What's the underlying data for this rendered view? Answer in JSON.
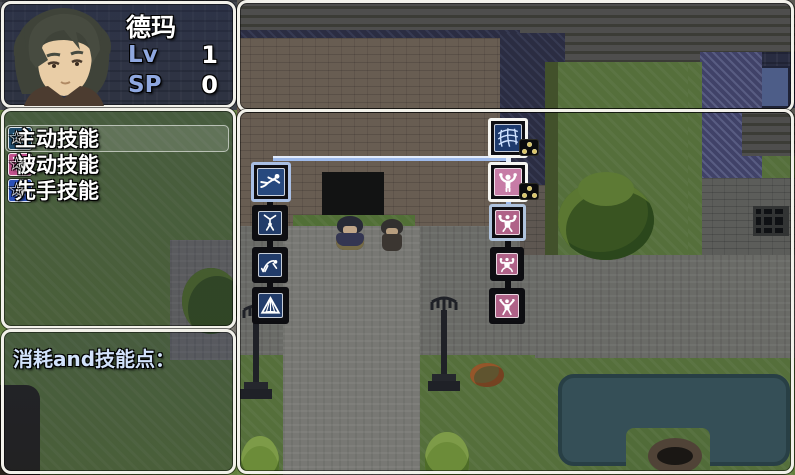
{
  "character_panel": {
    "name": "德玛",
    "level_label": "Lv",
    "level_value": "1",
    "sp_label": "SP",
    "sp_value": "0",
    "portrait_icon": "male-dark-hair-portrait"
  },
  "skill_menu": {
    "items": [
      {
        "label": "主动技能",
        "star": "☆",
        "icon": "fist-icon",
        "icon_bg": "#1f4a6a",
        "selected": true
      },
      {
        "label": "被动技能",
        "star": "☆",
        "icon": "sparkle-figure-icon",
        "icon_bg": "#c2538e",
        "selected": false
      },
      {
        "label": "先手技能",
        "star": "☆",
        "icon": "seated-figure-icon",
        "icon_bg": "#2b50b8",
        "selected": false
      }
    ]
  },
  "cost_panel": {
    "label": "消耗and技能点："
  },
  "skill_tree": {
    "colors": {
      "highlight": "#9db9ea",
      "highlight_light": "#e3ecfa",
      "inactive": "#0d0d11",
      "selected_frame": "#aec2dc",
      "unlocked_frame": "#f6f6f2",
      "blue_icon_bg": "#24406e",
      "pink_icon_bg": "#b06288"
    },
    "links": [
      {
        "x": 273,
        "y": 156,
        "w": 235,
        "h": 5,
        "color": "#9db9ea",
        "top": "#e3ecfa"
      },
      {
        "x": 506,
        "y": 152,
        "w": 5,
        "h": 14,
        "color": "#e3ecfa",
        "top": ""
      },
      {
        "x": 506,
        "y": 197,
        "w": 5,
        "h": 12,
        "color": "#9db9ea",
        "top": ""
      },
      {
        "x": 505,
        "y": 238,
        "w": 6,
        "h": 14,
        "color": "#0d0d11",
        "top": ""
      },
      {
        "x": 505,
        "y": 277,
        "w": 6,
        "h": 15,
        "color": "#0d0d11",
        "top": ""
      },
      {
        "x": 267,
        "y": 198,
        "w": 6,
        "h": 11,
        "color": "#0d0d11",
        "top": ""
      },
      {
        "x": 267,
        "y": 238,
        "w": 6,
        "h": 13,
        "color": "#0d0d11",
        "top": ""
      },
      {
        "x": 267,
        "y": 278,
        "w": 6,
        "h": 13,
        "color": "#0d0d11",
        "top": ""
      }
    ],
    "nodes": [
      {
        "id": "dash",
        "icon": "dash-figure-icon",
        "x": 251,
        "y": 162,
        "size": 40,
        "frame": "#a9bfe4",
        "bg": "#27497e"
      },
      {
        "id": "cartwheel",
        "icon": "cartwheel-figure-icon",
        "x": 252,
        "y": 205,
        "size": 36,
        "frame": "#0d0d11",
        "bg": "#223c6a"
      },
      {
        "id": "backbend",
        "icon": "backbend-figure-icon",
        "x": 252,
        "y": 247,
        "size": 36,
        "frame": "#0d0d11",
        "bg": "#223c6a"
      },
      {
        "id": "tent",
        "icon": "tent-icon",
        "x": 252,
        "y": 287,
        "size": 37,
        "frame": "#0d0d11",
        "bg": "#223c6a"
      },
      {
        "id": "net",
        "icon": "net-icon",
        "x": 488,
        "y": 118,
        "size": 40,
        "frame": "#f6f6f2",
        "bg": "#1d3a6d"
      },
      {
        "id": "arms-up",
        "icon": "arms-up-figure-icon",
        "x": 488,
        "y": 162,
        "size": 40,
        "frame": "#f6f6f2",
        "bg": "#c77ca6"
      },
      {
        "id": "muscle-1",
        "icon": "muscle-flex-icon",
        "x": 489,
        "y": 204,
        "size": 37,
        "frame": "#aec2dc",
        "bg": "#b06288"
      },
      {
        "id": "muscle-2",
        "icon": "muscle-crab-icon",
        "x": 490,
        "y": 247,
        "size": 34,
        "frame": "#0d0d11",
        "bg": "#b06288"
      },
      {
        "id": "muscle-3",
        "icon": "muscle-spread-icon",
        "x": 489,
        "y": 288,
        "size": 36,
        "frame": "#0d0d11",
        "bg": "#b06288"
      }
    ],
    "badges": [
      {
        "x": 519,
        "y": 139,
        "w": 20,
        "h": 17,
        "dots": 3
      },
      {
        "x": 519,
        "y": 183,
        "w": 20,
        "h": 17,
        "dots": 3
      }
    ]
  }
}
